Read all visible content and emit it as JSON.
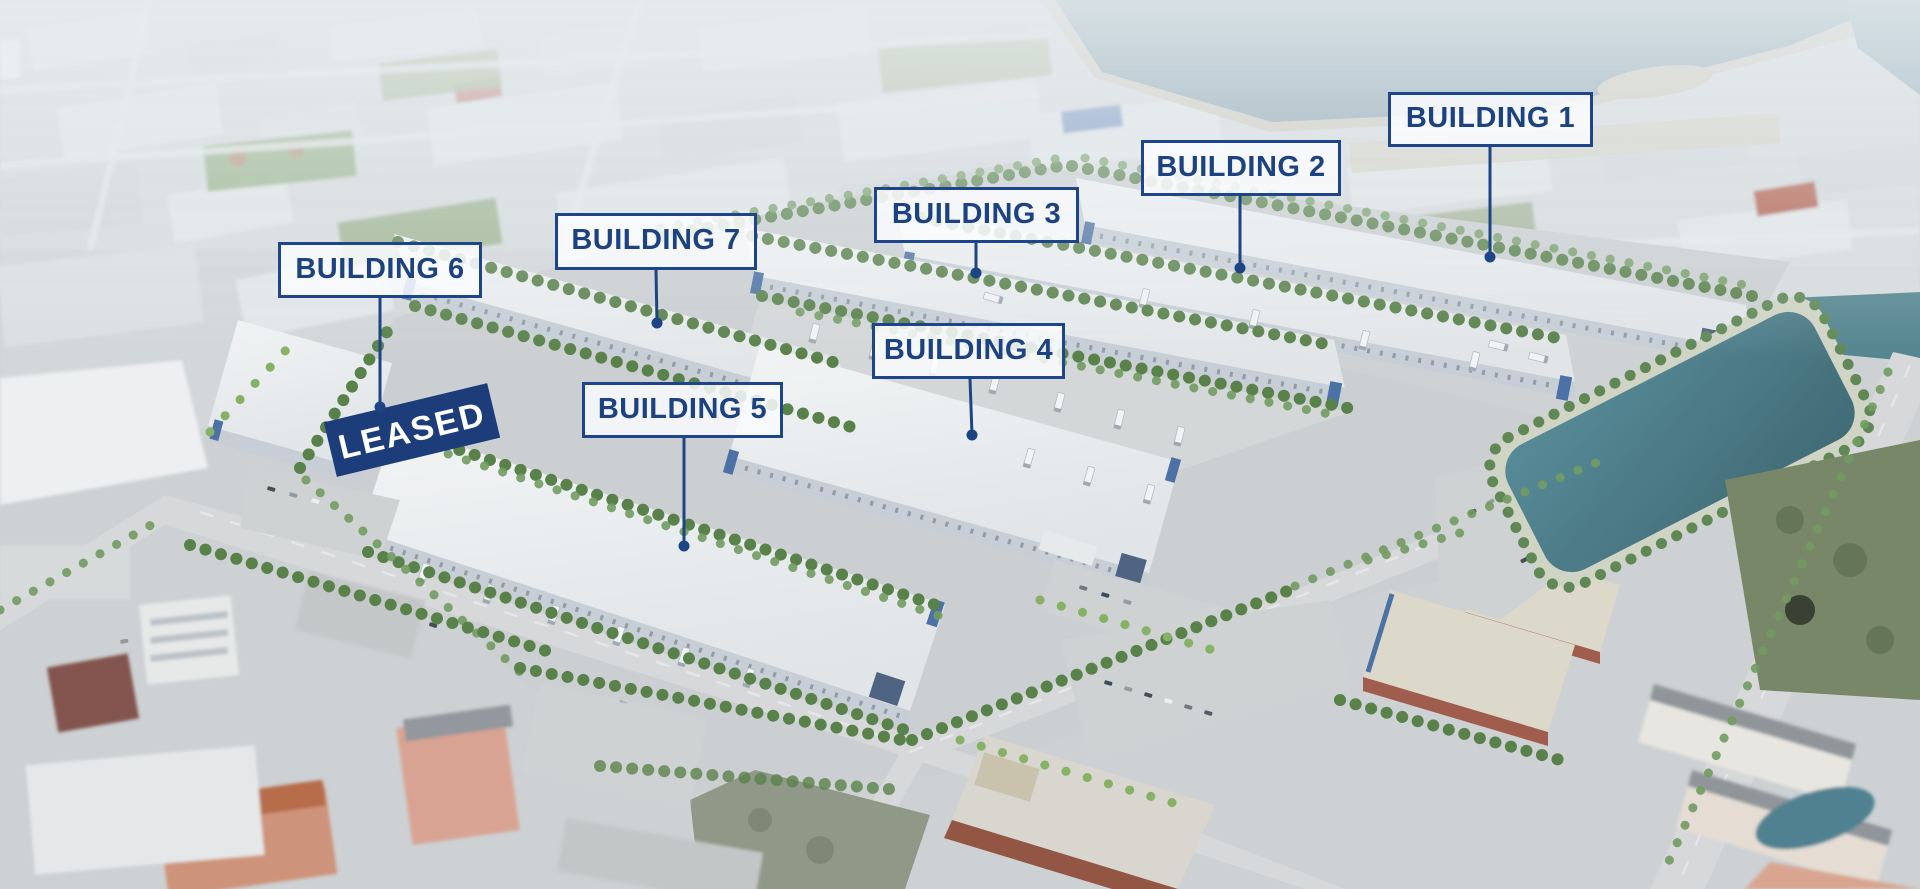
{
  "callouts": [
    {
      "id": "building-1",
      "label": "BUILDING 1"
    },
    {
      "id": "building-2",
      "label": "BUILDING 2"
    },
    {
      "id": "building-3",
      "label": "BUILDING 3"
    },
    {
      "id": "building-4",
      "label": "BUILDING 4"
    },
    {
      "id": "building-5",
      "label": "BUILDING 5"
    },
    {
      "id": "building-6",
      "label": "BUILDING 6"
    },
    {
      "id": "building-7",
      "label": "BUILDING 7"
    }
  ],
  "banner": {
    "text": "LEASED"
  },
  "colors": {
    "callout_text": "#1d4282",
    "callout_border": "#1e4589",
    "callout_bg": "rgba(250,252,254,0.85)",
    "leader_line": "#1d4584",
    "banner_bg": "#1c3d7a",
    "banner_text": "#ffffff",
    "pond_teal": "#44798a",
    "lake_water": "#7d97a5"
  }
}
